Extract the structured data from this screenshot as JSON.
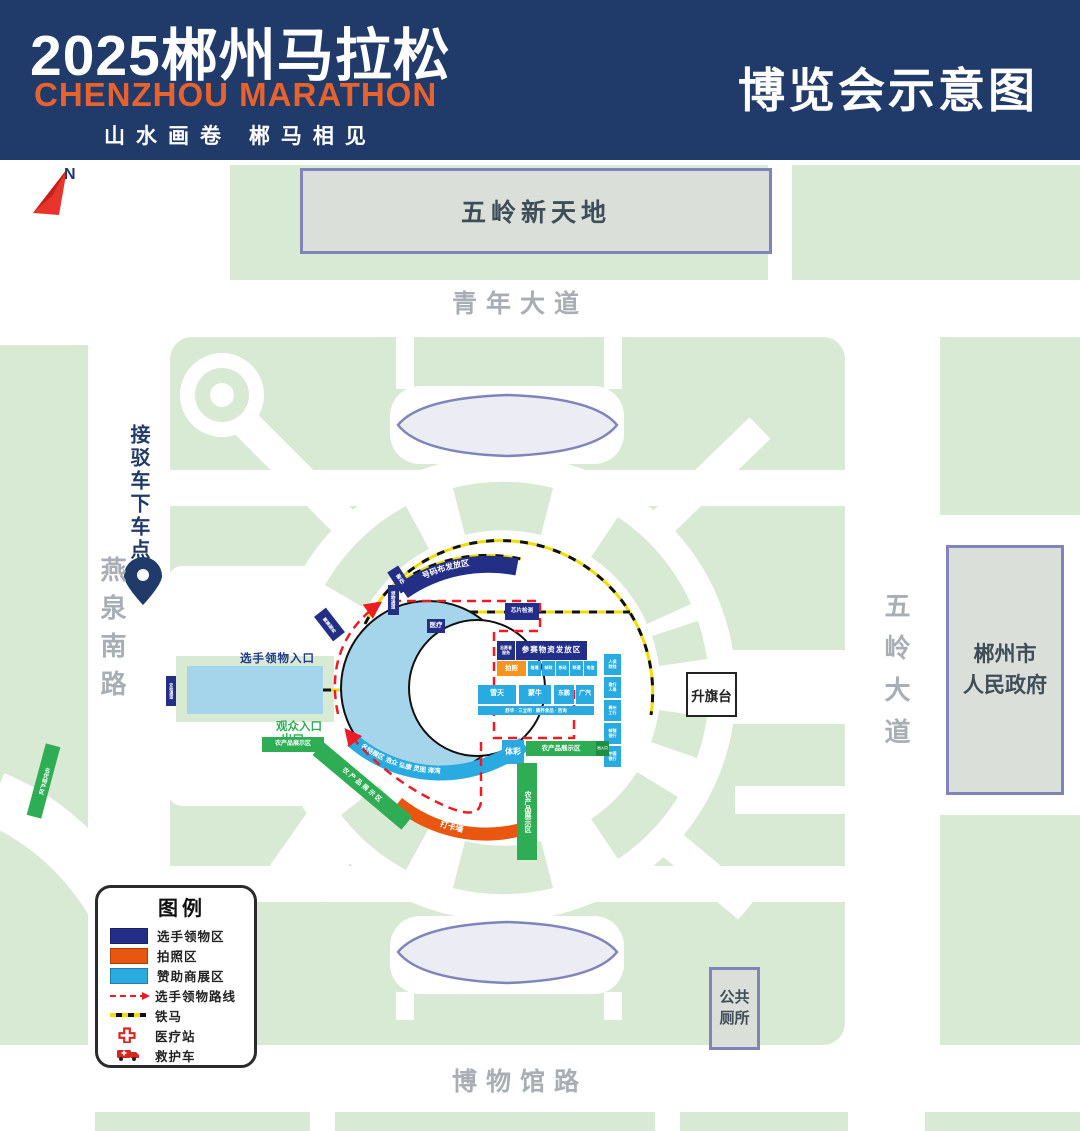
{
  "header": {
    "title": "2025郴州马拉松",
    "subtitle_en": "CHENZHOU MARATHON",
    "slogan": "山水画卷  郴马相见",
    "map_title": "博览会示意图"
  },
  "compass": {
    "north": "N"
  },
  "streets": {
    "qingnian_avenue": "青年大道",
    "museum_road": "博物馆路",
    "yanquan_south_road": "燕泉南路",
    "wuling_avenue": "五岭大道"
  },
  "places": {
    "wuling_xintiandi": "五岭新天地",
    "government": "郴州市\n人民政府",
    "flag_stage": "升旗台",
    "public_toilet": "公共\n厕所",
    "shuttle_drop_off": "接驳车下车点"
  },
  "entrances": {
    "athlete_pickup_entrance": "选手领物入口",
    "spectator_entrance": "观众入口",
    "exit": "出口"
  },
  "zones": {
    "bib_area": "号码布发放区",
    "storage": "寄存",
    "pickup_channel": "领物通道",
    "event_service": "赛事服务",
    "medical": "医疗",
    "chip_check": "芯片检测",
    "supplies_area": "参赛物资发放区",
    "volunteer": "志愿者\n服务",
    "photo_booth": "拍照",
    "sponsors_small": [
      "裕湘",
      "邮政",
      "移动",
      "联通",
      "电信"
    ],
    "sponsors_main": [
      "雪天",
      "蒙牛",
      "东鹏",
      "广汽"
    ],
    "sponsors_strip": "舒华 · 三立明 · 康养食品 · 咨询",
    "sponsors_side": [
      "人保\n财险",
      "建行\n人寿",
      "郴州\n工行",
      "邮储\n银行",
      "中国\n银行"
    ],
    "lottery": "体彩",
    "agri_display": "农产品展示区",
    "agri_gate": "出入口",
    "specialty_zone": "名优特产区",
    "expo_arc": "名特展区  浩众  弘康  灵图  津湾",
    "photo_wall": "打卡墙",
    "security_channel": "安检通道"
  },
  "legend": {
    "title": "图例",
    "items": [
      {
        "label": "选手领物区"
      },
      {
        "label": "拍照区"
      },
      {
        "label": "赞助商展区"
      },
      {
        "label": "选手领物路线"
      },
      {
        "label": "铁马"
      },
      {
        "label": "医疗站"
      },
      {
        "label": "救护车"
      }
    ]
  },
  "colors": {
    "header_navy": "#203a69",
    "booth_navy": "#232e87",
    "sponsor_blue": "#29abe2",
    "zone_green": "#2fad54",
    "block_green": "#d8e9d4",
    "photo_orange": "#e8560f",
    "route_red": "#ed1c24",
    "barrier_yellow": "#f2dc00",
    "accent_orange": "#e8622d"
  }
}
